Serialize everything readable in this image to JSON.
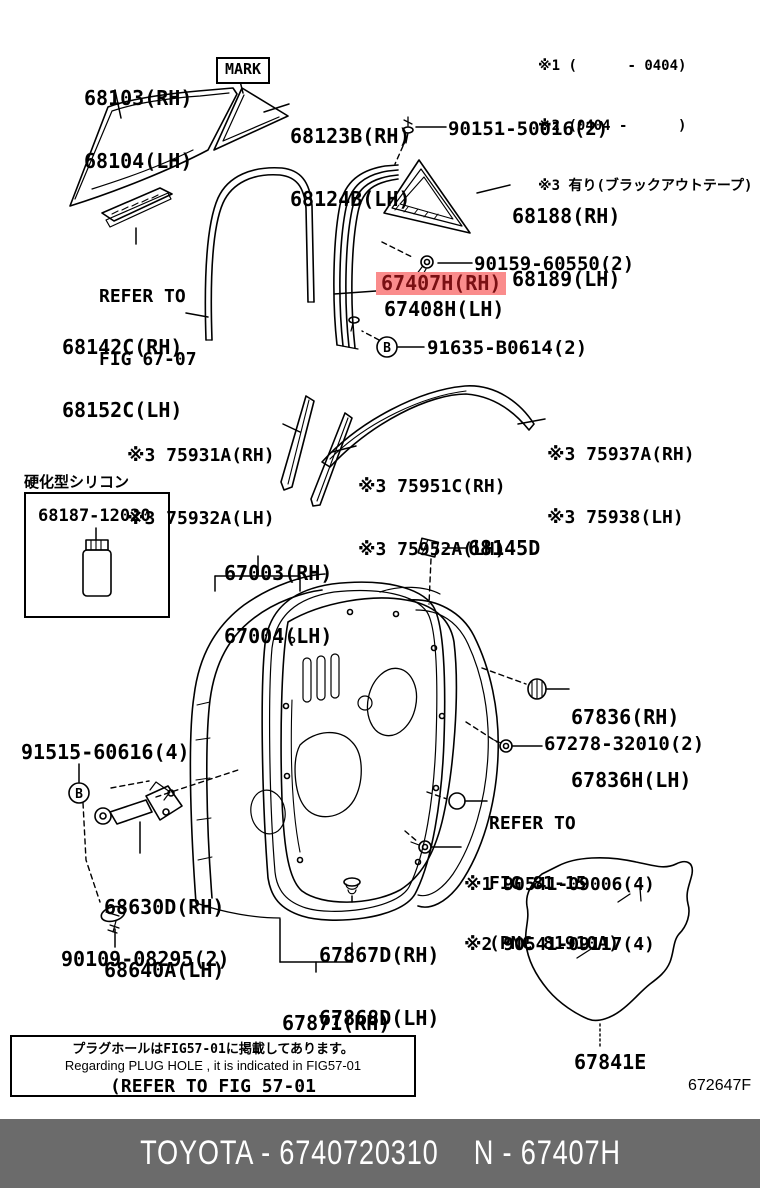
{
  "notes": {
    "n1": "※1 (      - 0404)",
    "n2": "※2 (0404 -      )",
    "n3": "※3 有り(ブラックアウトテープ)"
  },
  "mark_tag": "MARK",
  "marker_b": "B",
  "parts": {
    "glass": {
      "rh": "68103(RH)",
      "lh": "68104(LH)"
    },
    "quarter_molding": {
      "rh": "68123B(RH)",
      "lh": "68124B(LH)"
    },
    "clip_90151": "90151-50016(2)",
    "quarter_glass": {
      "rh": "68188(RH)",
      "lh": "68189(LH)"
    },
    "screw_90159": "90159-60550(2)",
    "frame_selected": {
      "rh": "67407H(RH)",
      "lh": "67408H(LH)"
    },
    "bolt_91635": "91635-B0614(2)",
    "run_channel": {
      "rh": "68142C(RH)",
      "lh": "68152C(LH)"
    },
    "belt_molding_front": {
      "rh": "※3 75931A(RH)",
      "lh": "※3 75932A(LH)"
    },
    "belt_molding_rear": {
      "rh": "※3 75951C(RH)",
      "lh": "※3 75952A(LH)"
    },
    "roof_molding": {
      "rh": "※3 75937A(RH)",
      "lh": "※3 75938(LH)"
    },
    "silicon": {
      "caption": "硬化型シリコン",
      "number": "68187-12020"
    },
    "door_panel": {
      "rh": "67003(RH)",
      "lh": "67004(LH)"
    },
    "cushion_68145": "68145D",
    "cushion_67836": {
      "rh": "67836(RH)",
      "lh": "67836H(LH)"
    },
    "clip_67278": "67278-32010(2)",
    "screw_90541": {
      "v1": "※1 90541-09006(4)",
      "v2": "※2 90541-09117(4)"
    },
    "bolt_91515": "91515-60616(4)",
    "check": {
      "rh": "68630D(RH)",
      "lh": "68640A(LH)"
    },
    "bolt_90109": "90109-08295(2)",
    "clip_67867": {
      "rh": "67867D(RH)",
      "lh": "67868D(LH)"
    },
    "weatherstrip": {
      "rh": "67871(RH)",
      "lh": "67872(LH)"
    },
    "hole_cover": "67841E"
  },
  "references": {
    "fig6707": {
      "l1": "REFER TO",
      "l2": "FIG 67-07"
    },
    "fig8115": {
      "l1": "REFER TO",
      "l2": "FIG 81-15",
      "l3": "(PNC 81910A)"
    }
  },
  "note_box": {
    "jp": "プラグホールはFIG57-01に掲載してあります。",
    "en": "Regarding PLUG HOLE , it is indicated in FIG57-01",
    "refer": "(REFER TO FIG 57-01"
  },
  "figure_code": "672647F",
  "footer": {
    "brand_part": "TOYOTA - 6740720310",
    "code": "N - 67407H"
  },
  "colors": {
    "highlight_bg": "#fa8c8c",
    "highlight_text": "#7a1013",
    "footer_bg": "#6b6b6b"
  }
}
